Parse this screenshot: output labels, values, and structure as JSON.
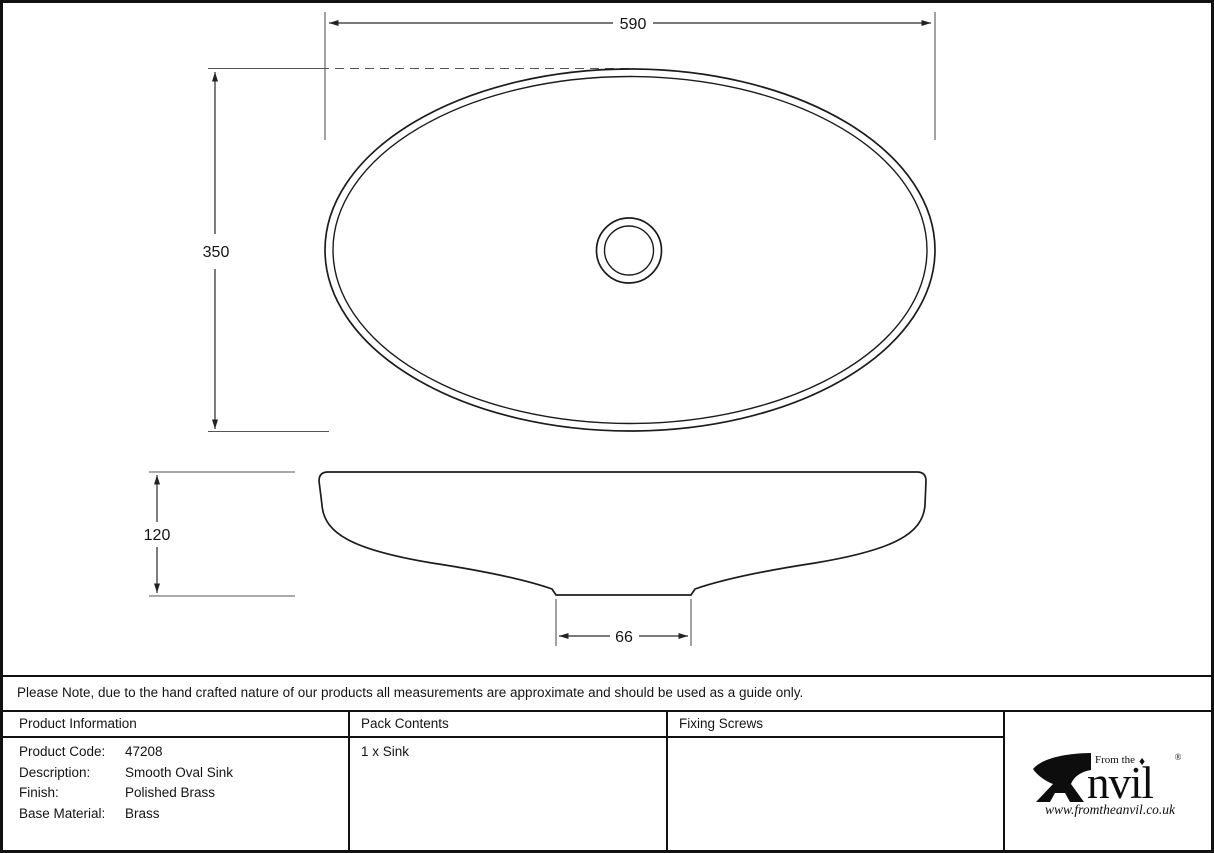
{
  "drawing": {
    "description": "Technical drawing of smooth oval sink, top view and side profile",
    "dimensions": {
      "top_width": "590",
      "top_height": "350",
      "side_height": "120",
      "base_width": "66"
    }
  },
  "note": "Please Note, due to the hand crafted nature of our products all measurements are approximate and should be used as a guide only.",
  "table": {
    "product_information": {
      "header": "Product Information",
      "rows": [
        {
          "label": "Product Code:",
          "value": "47208"
        },
        {
          "label": "Description:",
          "value": "Smooth Oval Sink"
        },
        {
          "label": "Finish:",
          "value": "Polished Brass"
        },
        {
          "label": "Base Material:",
          "value": "Brass"
        }
      ]
    },
    "pack_contents": {
      "header": "Pack Contents",
      "value": "1 x Sink"
    },
    "fixing_screws": {
      "header": "Fixing Screws",
      "value": ""
    }
  },
  "logo": {
    "tagline": "From the",
    "diamond": "♦",
    "brand": "nvil",
    "brand_full": "Anvil",
    "registered": "®",
    "url": "www.fromtheanvil.co.uk",
    "anvil_icon": "anvil-icon"
  },
  "colors": {
    "line": "#111111",
    "outline": "#1c1c1c",
    "dimension": "#2a2a2a",
    "background": "#ffffff"
  }
}
